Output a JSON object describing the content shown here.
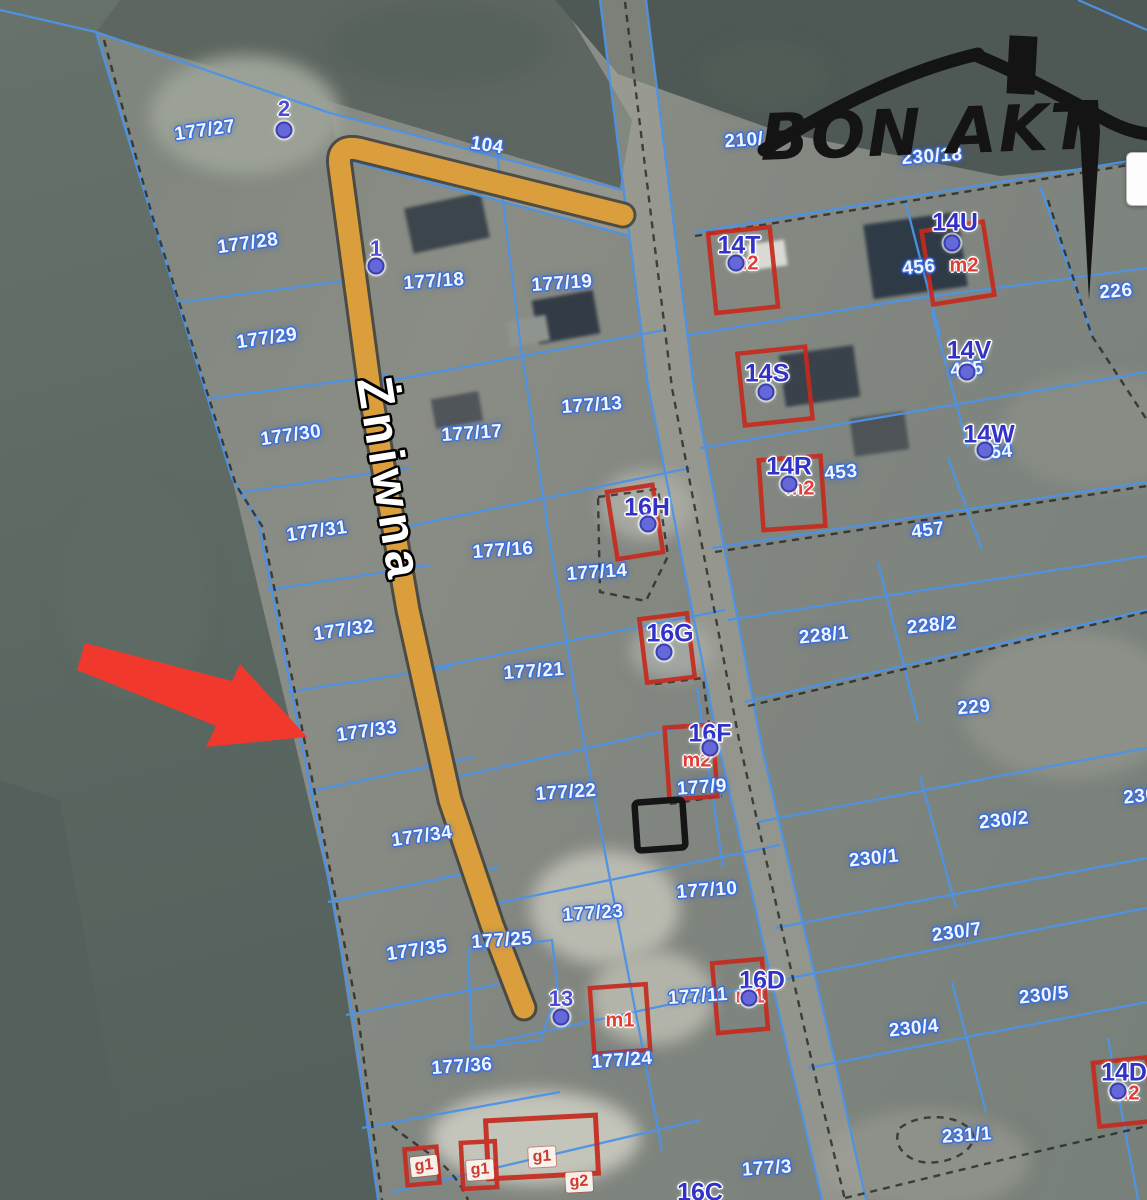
{
  "page": {
    "type": "cadastral-map-viewer"
  },
  "logo": {
    "text": "BON AKT"
  },
  "street": {
    "name": "Żniwna"
  },
  "colors": {
    "boundary_blue": "#4d93e6",
    "highlight_road_orange": "#e2a33c",
    "building_outline_red": "#c62a1e",
    "arrow_red": "#f0392c",
    "parcel_label_white": "#f2f5ff",
    "building_id_blue": "#3232c8",
    "unit_label_red": "#e23d35",
    "logo_black": "#141414"
  },
  "labels": {
    "parcels": [
      {
        "t": "177/27",
        "x": 205,
        "y": 131,
        "r": -8
      },
      {
        "t": "104",
        "x": 487,
        "y": 146,
        "r": 9
      },
      {
        "t": "210/",
        "x": 744,
        "y": 141,
        "r": -4
      },
      {
        "t": "230/18",
        "x": 932,
        "y": 157,
        "r": -4
      },
      {
        "t": "177/28",
        "x": 248,
        "y": 244,
        "r": -8
      },
      {
        "t": "177/18",
        "x": 434,
        "y": 282,
        "r": -4
      },
      {
        "t": "177/19",
        "x": 562,
        "y": 284,
        "r": -4
      },
      {
        "t": "456",
        "x": 919,
        "y": 268,
        "r": -5
      },
      {
        "t": "226",
        "x": 1116,
        "y": 292,
        "r": -5
      },
      {
        "t": "177/29",
        "x": 267,
        "y": 339,
        "r": -8
      },
      {
        "t": "455",
        "x": 967,
        "y": 370,
        "r": -5
      },
      {
        "t": "177/13",
        "x": 592,
        "y": 406,
        "r": -4
      },
      {
        "t": "177/17",
        "x": 472,
        "y": 434,
        "r": -4
      },
      {
        "t": "177/30",
        "x": 291,
        "y": 436,
        "r": -8
      },
      {
        "t": "454",
        "x": 996,
        "y": 453,
        "r": -5
      },
      {
        "t": "453",
        "x": 841,
        "y": 473,
        "r": -5
      },
      {
        "t": "457",
        "x": 928,
        "y": 531,
        "r": -7
      },
      {
        "t": "177/31",
        "x": 317,
        "y": 532,
        "r": -8
      },
      {
        "t": "177/16",
        "x": 503,
        "y": 551,
        "r": -4
      },
      {
        "t": "177/14",
        "x": 597,
        "y": 573,
        "r": -4
      },
      {
        "t": "177/32",
        "x": 344,
        "y": 631,
        "r": -8
      },
      {
        "t": "228/1",
        "x": 824,
        "y": 636,
        "r": -6
      },
      {
        "t": "228/2",
        "x": 932,
        "y": 626,
        "r": -6
      },
      {
        "t": "177/21",
        "x": 534,
        "y": 672,
        "r": -4
      },
      {
        "t": "229",
        "x": 974,
        "y": 708,
        "r": -5
      },
      {
        "t": "177/33",
        "x": 367,
        "y": 732,
        "r": -8
      },
      {
        "t": "177/9",
        "x": 702,
        "y": 788,
        "r": -4
      },
      {
        "t": "230/2",
        "x": 1004,
        "y": 821,
        "r": -6
      },
      {
        "t": "177/22",
        "x": 566,
        "y": 793,
        "r": -4
      },
      {
        "t": "230/1",
        "x": 874,
        "y": 859,
        "r": -6
      },
      {
        "t": "230",
        "x": 1140,
        "y": 797,
        "r": -6
      },
      {
        "t": "177/34",
        "x": 422,
        "y": 837,
        "r": -8
      },
      {
        "t": "230/7",
        "x": 957,
        "y": 933,
        "r": -8
      },
      {
        "t": "177/10",
        "x": 707,
        "y": 891,
        "r": -4
      },
      {
        "t": "177/23",
        "x": 593,
        "y": 914,
        "r": -4
      },
      {
        "t": "230/5",
        "x": 1044,
        "y": 996,
        "r": -6
      },
      {
        "t": "177/35",
        "x": 417,
        "y": 951,
        "r": -8
      },
      {
        "t": "177/25",
        "x": 502,
        "y": 941,
        "r": -4
      },
      {
        "t": "230/4",
        "x": 914,
        "y": 1029,
        "r": -6
      },
      {
        "t": "177/11",
        "x": 698,
        "y": 997,
        "r": -4
      },
      {
        "t": "177/24",
        "x": 622,
        "y": 1061,
        "r": -4
      },
      {
        "t": "177/36",
        "x": 462,
        "y": 1067,
        "r": -4
      },
      {
        "t": "231/1",
        "x": 967,
        "y": 1136,
        "r": -4
      },
      {
        "t": "177/3",
        "x": 767,
        "y": 1169,
        "r": -4
      }
    ],
    "building_ids": [
      {
        "t": "14T",
        "x": 739,
        "y": 246
      },
      {
        "t": "14U",
        "x": 955,
        "y": 223
      },
      {
        "t": "14S",
        "x": 767,
        "y": 374
      },
      {
        "t": "14V",
        "x": 969,
        "y": 351
      },
      {
        "t": "14W",
        "x": 989,
        "y": 435
      },
      {
        "t": "14R",
        "x": 789,
        "y": 467
      },
      {
        "t": "16H",
        "x": 647,
        "y": 508
      },
      {
        "t": "16G",
        "x": 670,
        "y": 634
      },
      {
        "t": "16F",
        "x": 710,
        "y": 734
      },
      {
        "t": "16D",
        "x": 762,
        "y": 981
      },
      {
        "t": "14D",
        "x": 1124,
        "y": 1073
      },
      {
        "t": "16C",
        "x": 700,
        "y": 1193
      }
    ],
    "units": [
      {
        "t": "m2",
        "x": 744,
        "y": 264
      },
      {
        "t": "m2",
        "x": 964,
        "y": 266
      },
      {
        "t": "m2",
        "x": 800,
        "y": 489
      },
      {
        "t": "m2",
        "x": 697,
        "y": 761
      },
      {
        "t": "m1",
        "x": 750,
        "y": 997
      },
      {
        "t": "m1",
        "x": 620,
        "y": 1021
      },
      {
        "t": "m2",
        "x": 1125,
        "y": 1094
      }
    ],
    "outbuildings": [
      {
        "t": "g1",
        "x": 424,
        "y": 1166,
        "r": -6
      },
      {
        "t": "g1",
        "x": 480,
        "y": 1170,
        "r": -4
      },
      {
        "t": "g1",
        "x": 542,
        "y": 1157,
        "r": -3
      },
      {
        "t": "g2",
        "x": 579,
        "y": 1182,
        "r": -3
      }
    ],
    "points": [
      {
        "t": "2",
        "x": 284,
        "y": 109,
        "dx": 284,
        "dy": 130
      },
      {
        "t": "1",
        "x": 376,
        "y": 249,
        "dx": 376,
        "dy": 266
      },
      {
        "t": "13",
        "x": 561,
        "y": 999,
        "dx": 561,
        "dy": 1017
      }
    ],
    "dots": [
      [
        736,
        263
      ],
      [
        766,
        392
      ],
      [
        789,
        484
      ],
      [
        952,
        243
      ],
      [
        967,
        372
      ],
      [
        985,
        450
      ],
      [
        648,
        524
      ],
      [
        664,
        652
      ],
      [
        710,
        748
      ],
      [
        749,
        998
      ],
      [
        1118,
        1091
      ]
    ]
  }
}
